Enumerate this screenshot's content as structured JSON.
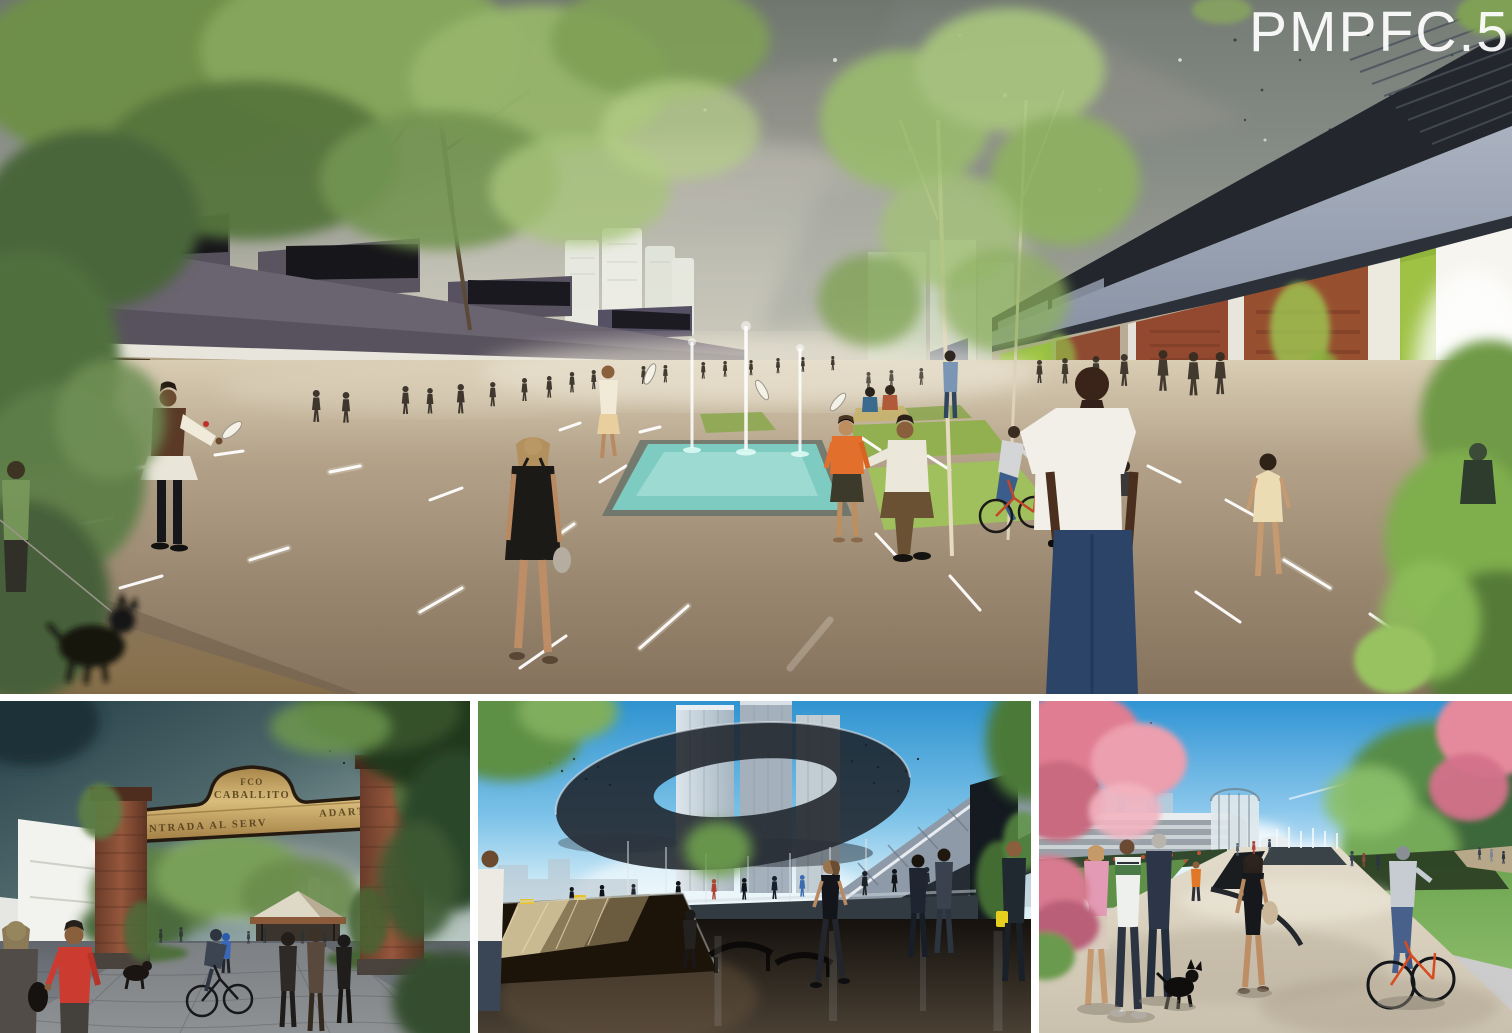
{
  "board": {
    "title": "PMPFC.5"
  },
  "arch_sign": {
    "line1": "FCO",
    "line2": "CABALLITO",
    "line3": "ENTRADA  AL  SERV",
    "line4": "ADARTNE"
  },
  "colors": {
    "title_text": "#ffffff",
    "main_sky_top": "#6f766e",
    "main_sky_horizon": "#cbc7b8",
    "warehouse_roof": "#6a6370",
    "brick": "#8f4a32",
    "accent_green": "#a3c63e",
    "plaza_paving": "#9a8770",
    "fountain_water": "#7ecbc2",
    "arch_sky": "#2e4a52",
    "arch_gold": "#c9a85c",
    "arch_brick": "#7a4632",
    "hub_sky": "#42a0d6",
    "hub_canopy": "#1c2128",
    "hub_floor": "#241e16",
    "prom_sky": "#4aa4e0",
    "prom_blossom": "#e8849a",
    "prom_path": "#ddd5c4",
    "prom_grass": "#649544"
  }
}
